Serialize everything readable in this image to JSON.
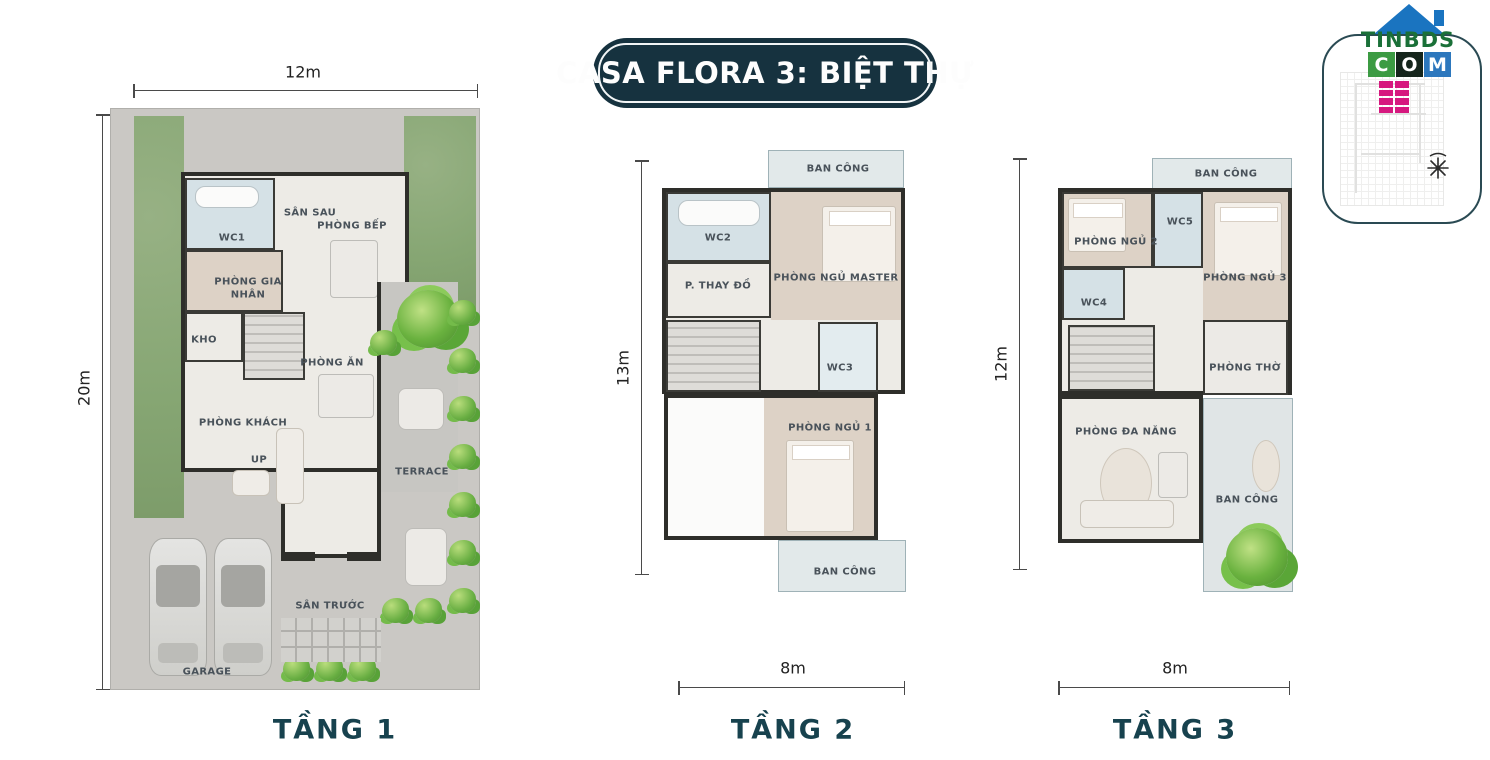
{
  "title": "CASA FLORA 3: BIỆT THỰ",
  "logo": {
    "name": "TINBDS",
    "tld": [
      "C",
      "O",
      "M"
    ]
  },
  "floor1": {
    "title": "TẦNG 1",
    "width_dim": "12m",
    "height_dim": "20m",
    "rooms": {
      "san_sau": "SÂN SAU",
      "wc1": "WC1",
      "bep": "PHÒNG BẾP",
      "gia_nhan": "PHÒNG GIA NHÂN",
      "kho": "KHO",
      "an": "PHÒNG ĂN",
      "khach": "PHÒNG KHÁCH",
      "up": "UP",
      "terrace": "TERRACE",
      "san_truoc": "SÂN TRƯỚC",
      "garage": "GARAGE"
    }
  },
  "floor2": {
    "title": "TẦNG 2",
    "width_dim": "8m",
    "height_dim": "13m",
    "rooms": {
      "balcony_top": "BAN CÔNG",
      "wc2": "WC2",
      "thay_do": "P. THAY ĐỒ",
      "master": "PHÒNG NGỦ MASTER",
      "wc3": "WC3",
      "ngu1": "PHÒNG NGỦ 1",
      "balcony_bottom": "BAN CÔNG"
    }
  },
  "floor3": {
    "title": "TẦNG 3",
    "width_dim": "8m",
    "height_dim": "12m",
    "rooms": {
      "balcony_top": "BAN CÔNG",
      "ngu2": "PHÒNG NGỦ 2",
      "wc5": "WC5",
      "ngu3": "PHÒNG NGỦ 3",
      "wc4": "WC4",
      "tho": "PHÒNG THỜ",
      "da_nang": "PHÒNG ĐA NĂNG",
      "balcony_bottom": "BAN CÔNG"
    }
  },
  "colors": {
    "banner_navy": "#16323f",
    "floor_label_teal": "#17424e",
    "grass_green": "#86a673",
    "wall_dark": "#2e2e2a",
    "wc_tile_blue": "#d5e1e6",
    "bedroom_beige": "#ddd2c6",
    "logo_green": "#1a7038",
    "logo_blue": "#1a74c0",
    "logo_magenta": "#d6197f"
  }
}
